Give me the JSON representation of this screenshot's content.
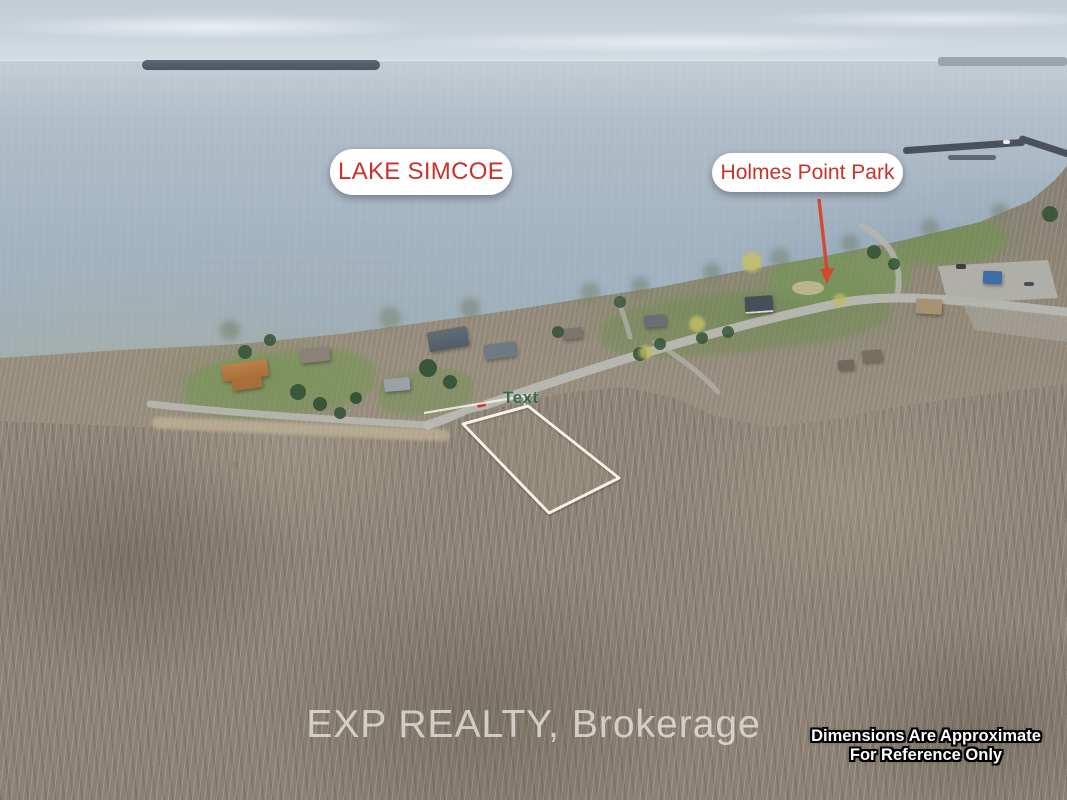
{
  "annotations": {
    "lake_label": "LAKE SIMCOE",
    "park_label": "Holmes Point Park",
    "lot_label": "Text",
    "watermark": "EXP REALTY, Brokerage",
    "disclaimer": {
      "line1": "Dimensions Are Approximate",
      "line2": "For Reference Only"
    }
  },
  "colors": {
    "annotation_red": "#cb3129",
    "arrow_red": "#d6452e",
    "pill_background": "#ffffff",
    "boundary_white": "#f6f2e6",
    "lot_label_green": "#2a5f45",
    "watermark_gray": "rgba(238,238,234,0.72)",
    "disclaimer_text": "#ffffff",
    "disclaimer_outline": "#000000"
  },
  "scene": {
    "subject": "Aerial drone photo of a vacant treed lot with white property boundary outline, Lake Simcoe shoreline houses and Holmes Point Park"
  }
}
